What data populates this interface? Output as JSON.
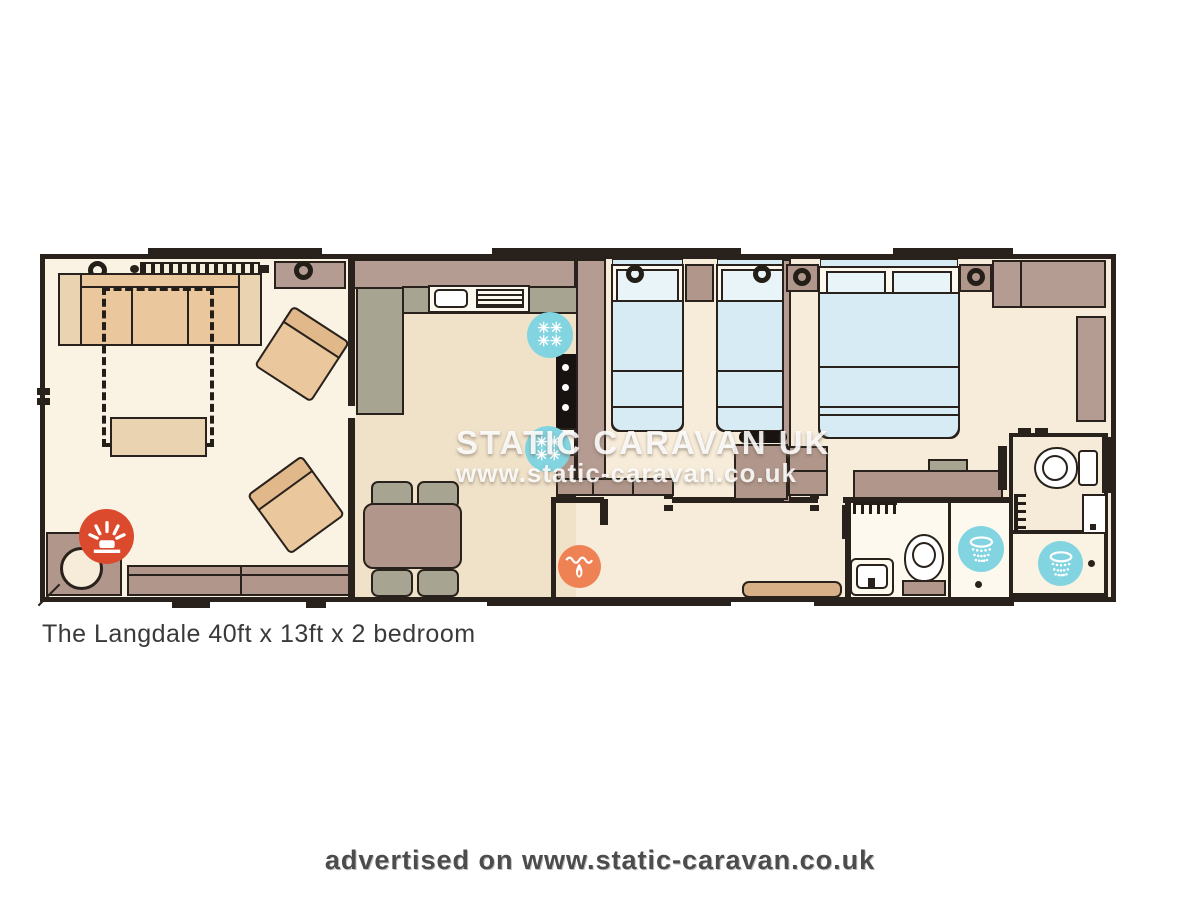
{
  "caption": "The Langdale 40ft x 13ft x 2 bedroom",
  "watermark": {
    "line1": "STATIC CARAVAN UK",
    "line2": "www.static-caravan.co.uk"
  },
  "footer": "advertised on www.static-caravan.co.uk",
  "glyphs": {
    "snowflake": "✳"
  },
  "icons": [
    "fridge-icon",
    "freezer-icon",
    "fire-feature-icon",
    "boiler-flame-icon",
    "shower-icon",
    "toilet",
    "basin",
    "towel-rail",
    "ceiling-light",
    "window-band"
  ],
  "colors": {
    "floor": "#f7ecd9",
    "lounge_floor": "#faf2e2",
    "kitchen_floor": "#f0e2c9",
    "bathroom_floor": "#fdf9ef",
    "wall_dark": "#29221c",
    "wall_brown": "#b59c92",
    "furniture_brown": "#b1978b",
    "furniture_tan": "#eac79d",
    "counter_olive": "#a7a591",
    "bed_blue": "#d7ebf4",
    "icon_blue": "#82d4e0",
    "icon_red": "#dc4a2e",
    "icon_orange": "#ef8254"
  }
}
